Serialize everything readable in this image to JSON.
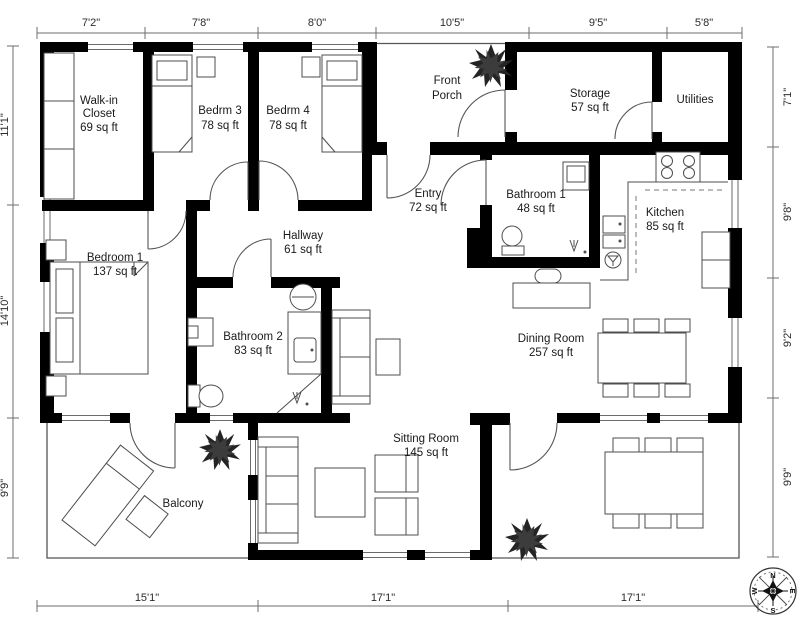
{
  "dimensions": {
    "top": [
      "7'2\"",
      "7'8\"",
      "8'0\"",
      "10'5\"",
      "9'5\"",
      "5'8\""
    ],
    "left": [
      "11'1\"",
      "14'10\"",
      "9'9\""
    ],
    "right": [
      "7'1\"",
      "9'8\"",
      "9'2\"",
      "9'9\""
    ],
    "bottom": [
      "15'1\"",
      "17'1\"",
      "17'1\""
    ]
  },
  "rooms": {
    "walk_in_closet": {
      "line1": "Walk-in",
      "line2": "Closet",
      "area": "69 sq ft"
    },
    "bedrm3": {
      "name": "Bedrm 3",
      "area": "78 sq ft"
    },
    "bedrm4": {
      "name": "Bedrm 4",
      "area": "78 sq ft"
    },
    "front_porch": {
      "line1": "Front",
      "line2": "Porch"
    },
    "storage": {
      "name": "Storage",
      "area": "57 sq ft"
    },
    "utilities": {
      "name": "Utilities"
    },
    "entry": {
      "name": "Entry",
      "area": "72 sq ft"
    },
    "bathroom1": {
      "name": "Bathroom 1",
      "area": "48 sq ft"
    },
    "kitchen": {
      "name": "Kitchen",
      "area": "85 sq ft"
    },
    "bedroom1": {
      "name": "Bedroom 1",
      "area": "137 sq ft"
    },
    "hallway": {
      "name": "Hallway",
      "area": "61 sq ft"
    },
    "bathroom2": {
      "name": "Bathroom 2",
      "area": "83 sq ft"
    },
    "dining_room": {
      "name": "Dining Room",
      "area": "257 sq ft"
    },
    "sitting_room": {
      "name": "Sitting Room",
      "area": "145 sq ft"
    },
    "balcony": {
      "name": "Balcony"
    }
  },
  "compass": {
    "north": "N",
    "east": "E",
    "south": "S",
    "west": "W"
  },
  "colors": {
    "wall": "#000000",
    "thin_line": "#555555",
    "text": "#1a1a1a"
  }
}
